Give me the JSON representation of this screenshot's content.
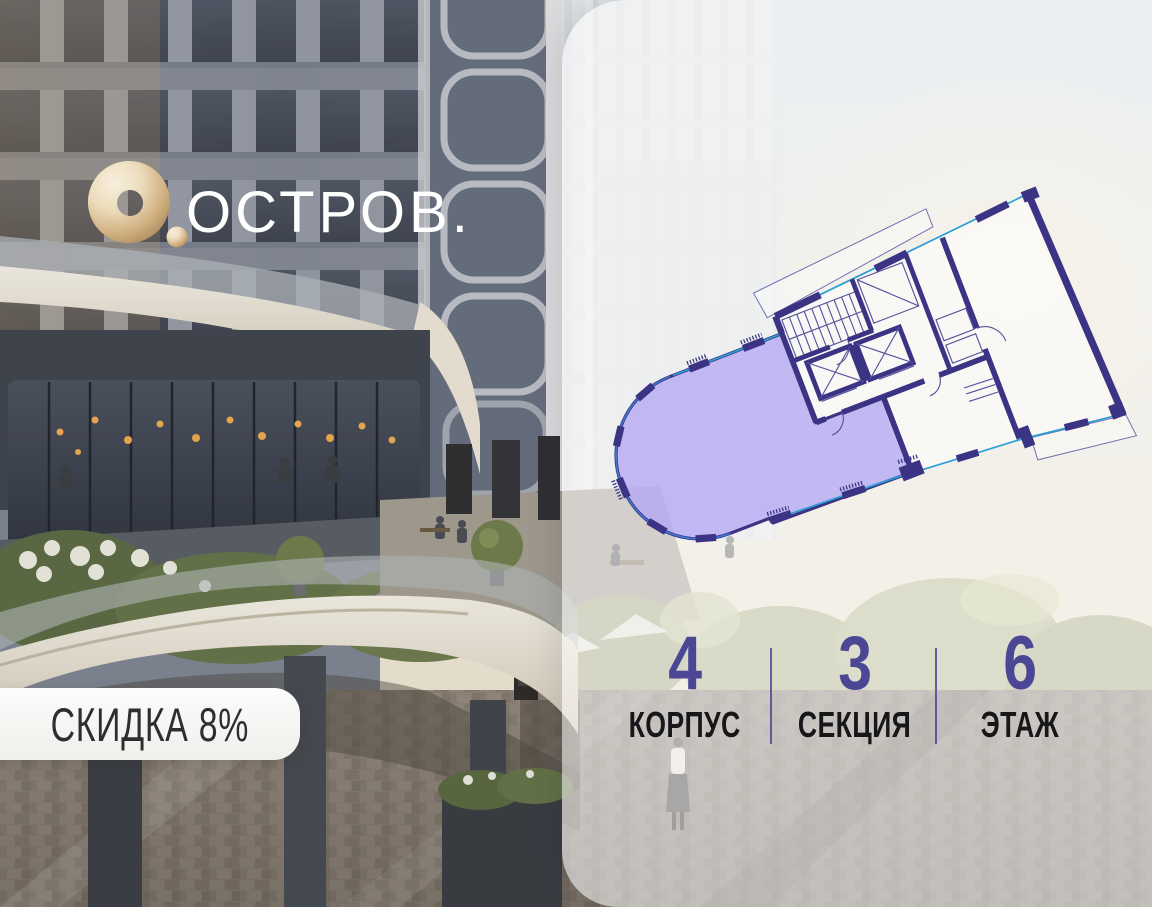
{
  "brand": {
    "name": "ОСТРОВ.",
    "mark": "gold-ring-logo",
    "gold_color": "#cfae7e",
    "text_color": "#ffffff"
  },
  "badge": {
    "label": "СКИДКА 8%"
  },
  "stats": [
    {
      "value": "4",
      "label": "КОРПУС"
    },
    {
      "value": "3",
      "label": "СЕКЦИЯ"
    },
    {
      "value": "6",
      "label": "ЭТАЖ"
    }
  ],
  "floor_plan": {
    "type": "apartment-floor-plan",
    "rotation_deg": -21,
    "highlighted_unit_fill": "#8f7cf0",
    "wall_color": "#3b3383",
    "window_color": "#2e9fd6",
    "features": [
      "highlighted-apartment",
      "staircase",
      "elevator-shafts",
      "corridor",
      "neighbor-unit",
      "balconies",
      "window-piers"
    ]
  },
  "colors": {
    "accent_purple": "#4c4795",
    "panel_overlay": "rgba(255,255,255,0.55)"
  }
}
